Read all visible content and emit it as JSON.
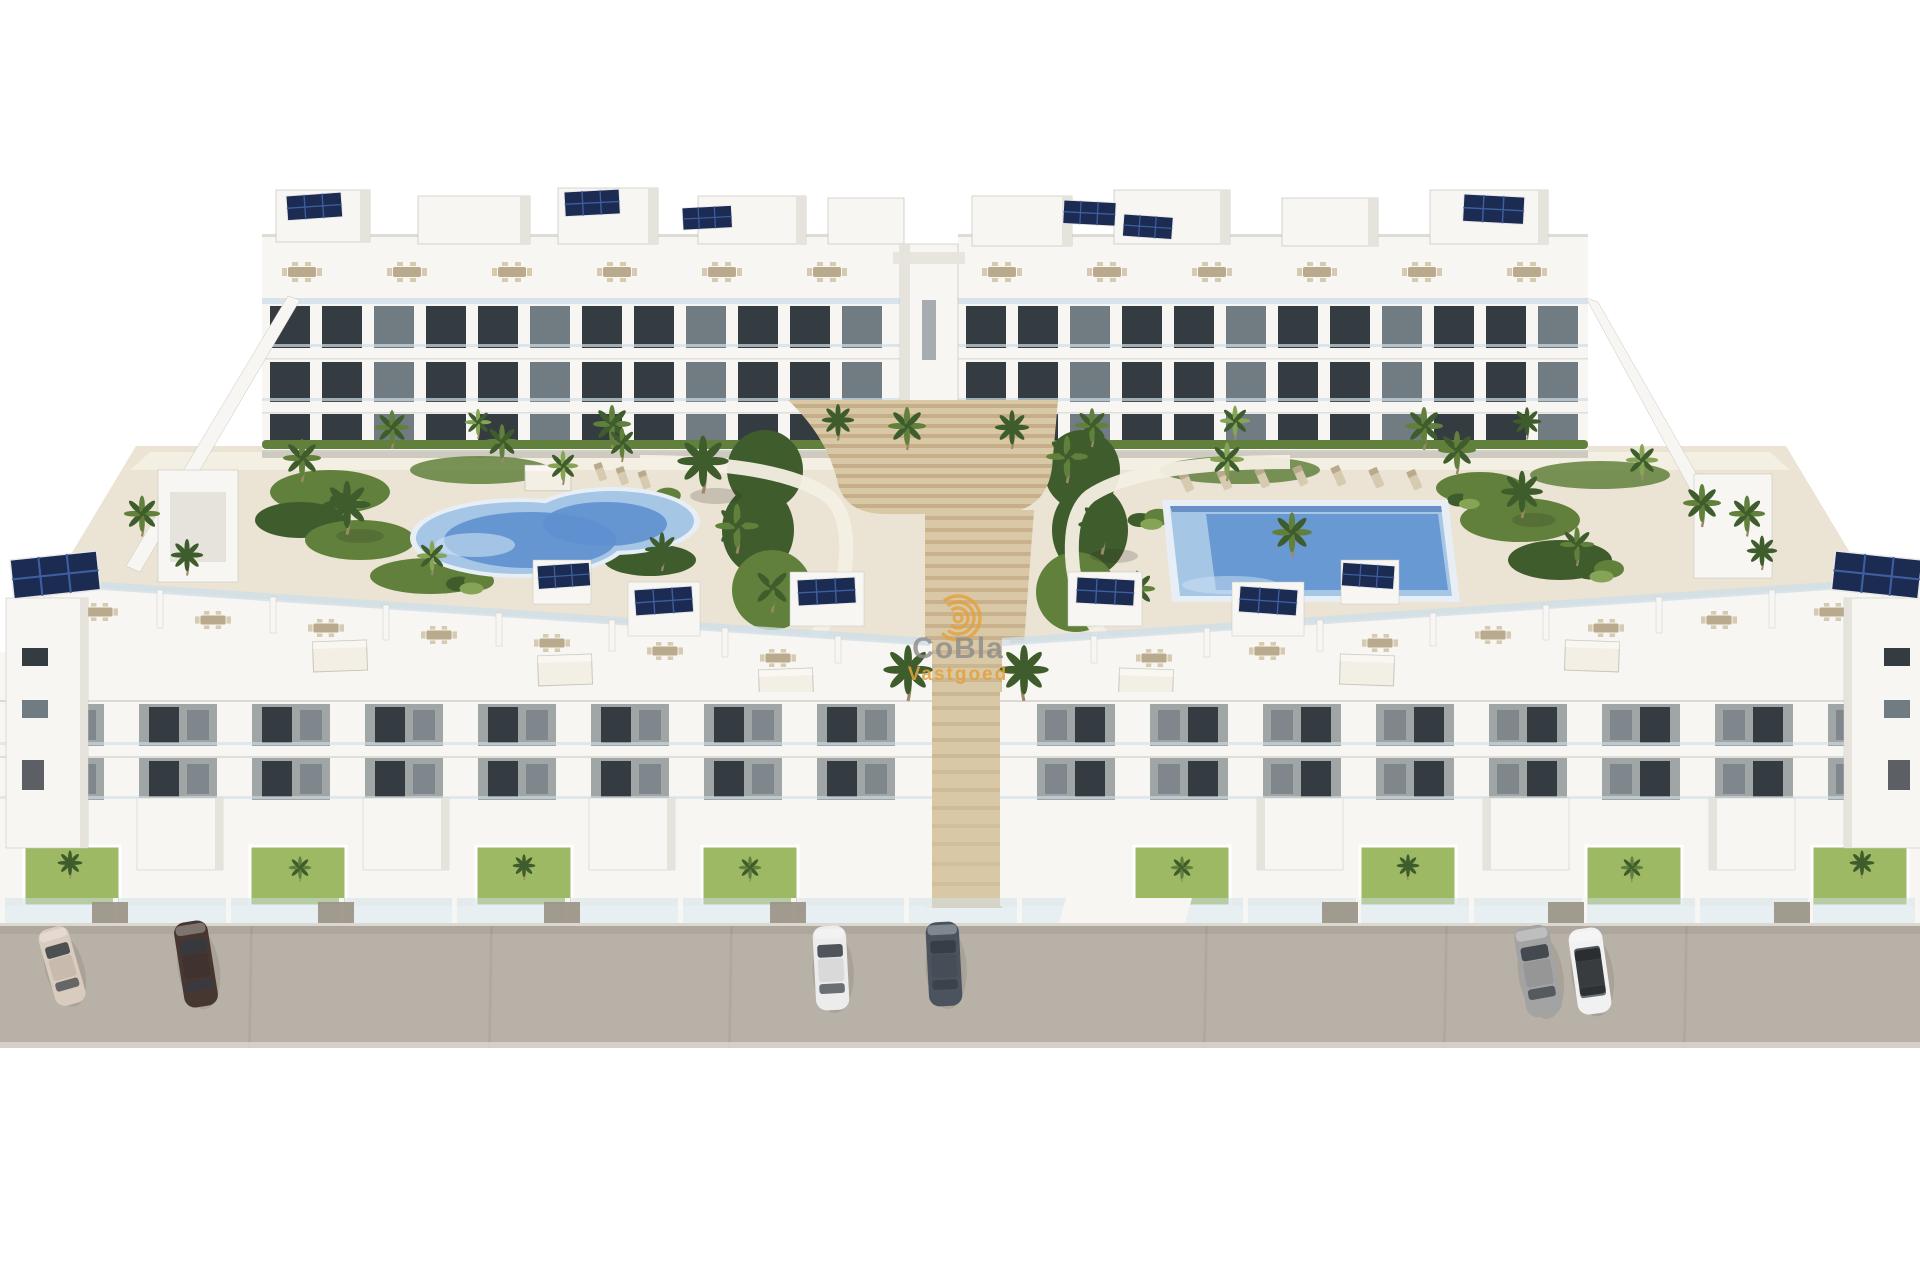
{
  "watermark": {
    "icon": "cobla-rings-icon",
    "title": "CoBla",
    "subtitle": "Vastgoed"
  },
  "scene": {
    "kind": "3d-architectural-render",
    "subject": "Aerial view of a white Mediterranean apartment complex with landscaped pool courtyard",
    "rear_apartment_blocks": 2,
    "front_apartment_blocks": 2,
    "visible_floors_per_block": 3,
    "pools": [
      {
        "name": "kidney-pool",
        "shape": "freeform"
      },
      {
        "name": "lap-pool",
        "shape": "rectangular"
      }
    ],
    "parked_cars": 6,
    "features": [
      "rooftop terraces with dining sets",
      "solar panels",
      "palm trees",
      "central timber steps",
      "glass balustrades",
      "street parking"
    ]
  },
  "palette": {
    "sky": "#ffffff",
    "building_white": "#f7f6f3",
    "building_shade": "#e6e3dc",
    "building_dark": "#c9c6be",
    "window_dark": "#343b41",
    "window_mid": "#707b82",
    "balcony_shadow": "#a0a6a6",
    "glass": "#cfdfe8",
    "solar_dark": "#1c2b52",
    "solar_cell": "#3d5fa0",
    "pool_rim": "#e7eef5",
    "pool_light": "#a6c6e6",
    "pool_deep": "#5e90cf",
    "courtyard": "#ebe3d3",
    "path_light": "#f4efe4",
    "wood_light": "#d9c8a6",
    "wood_dark": "#b3946c",
    "green_dark": "#3f5c2c",
    "green_mid": "#61803c",
    "green_light": "#86a455",
    "grass": "#9db964",
    "trunk": "#9b8a68",
    "street": "#b7b1a7",
    "street_edge": "#dcd7cf",
    "furniture_tan": "#b9aa8d",
    "furniture_light": "#d6cab1",
    "fence_panel": "#999184",
    "shadow": "rgba(40,35,25,0.18)",
    "watermark_orange": "#e4a23d",
    "watermark_gray": "#8d8d8d",
    "car_1": "#d9cbbd",
    "car_2": "#463732",
    "car_3": "#ececec",
    "car_4": "#4b545e",
    "car_5": "#a3a3a3",
    "car_6": "#f1f1f1",
    "car_roof_dark": "#262a2e"
  }
}
